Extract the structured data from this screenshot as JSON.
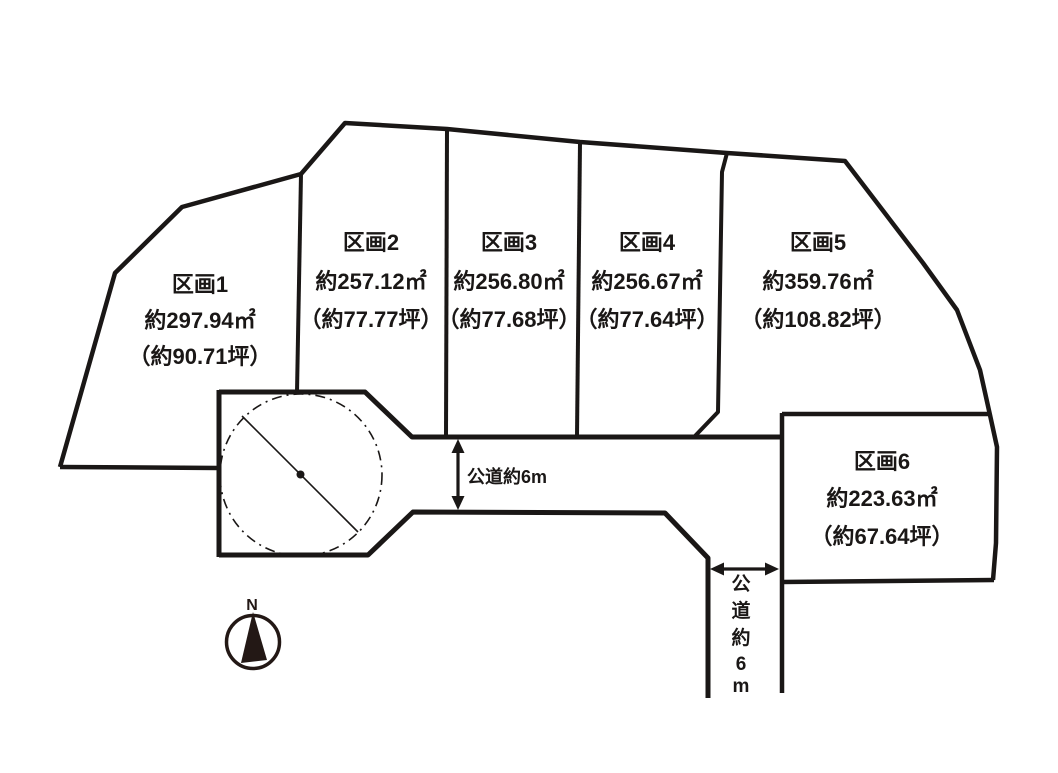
{
  "diagram": {
    "plots": [
      {
        "name": "区画1",
        "area": "約297.94㎡",
        "tsubo": "（約90.71坪）"
      },
      {
        "name": "区画2",
        "area": "約257.12㎡",
        "tsubo": "（約77.77坪）"
      },
      {
        "name": "区画3",
        "area": "約256.80㎡",
        "tsubo": "（約77.68坪）"
      },
      {
        "name": "区画4",
        "area": "約256.67㎡",
        "tsubo": "（約77.64坪）"
      },
      {
        "name": "区画5",
        "area": "約359.76㎡",
        "tsubo": "（約108.82坪）"
      },
      {
        "name": "区画6",
        "area": "約223.63㎡",
        "tsubo": "（約67.64坪）"
      }
    ],
    "roads": {
      "horizontal": {
        "label": "公道約6m"
      },
      "vertical": {
        "chars": [
          "公",
          "道",
          "約",
          "6",
          "m"
        ]
      }
    },
    "compass": {
      "label": "N"
    },
    "colors": {
      "line": "#1a1716",
      "compass": "#231815",
      "background": "#ffffff"
    }
  }
}
